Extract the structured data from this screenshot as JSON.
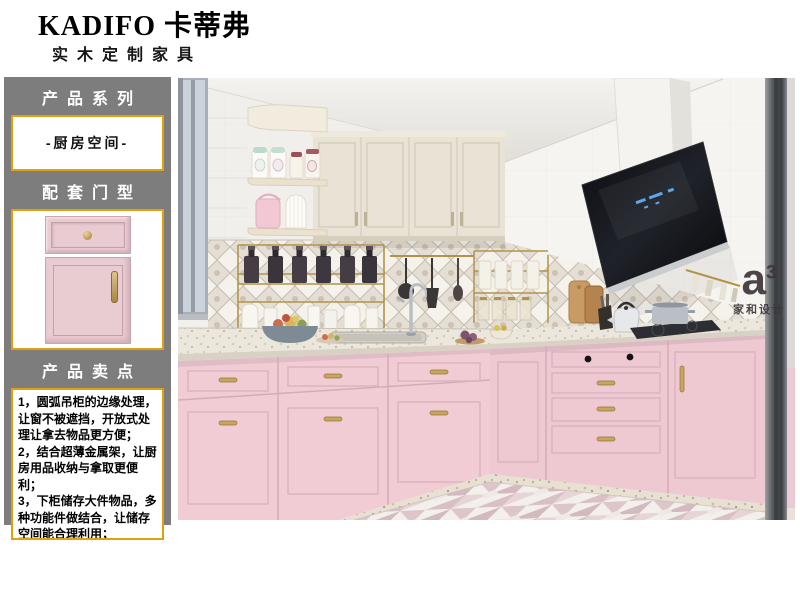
{
  "brand": {
    "name": "KADIFO 卡蒂弗",
    "tagline": "实木定制家具"
  },
  "sidebar": {
    "series": {
      "title": "产品系列",
      "value": "-厨房空间-"
    },
    "door_type": {
      "title": "配套门型"
    },
    "selling_points": {
      "title": "产品卖点",
      "points": [
        "1，圆弧吊柜的边缘处理，让窗不被遮挡，开放式处理让拿去物品更方便；",
        "2，结合超薄金属架，让厨房用品收纳与拿取更便利；",
        "3，下柜储存大件物品，多种功能件做结合，让储存空间能合理利用；"
      ]
    }
  },
  "photo": {
    "watermark": {
      "mark": "a",
      "sup": "3",
      "caption": "家和设计"
    }
  },
  "colors": {
    "sidebar_gray": "#7d7d7d",
    "accent_gold": "#dfa10d",
    "cabinet_pink": "#f0ccd4",
    "cabinet_cream": "#e9e3d5",
    "hood_black": "#17181c"
  }
}
